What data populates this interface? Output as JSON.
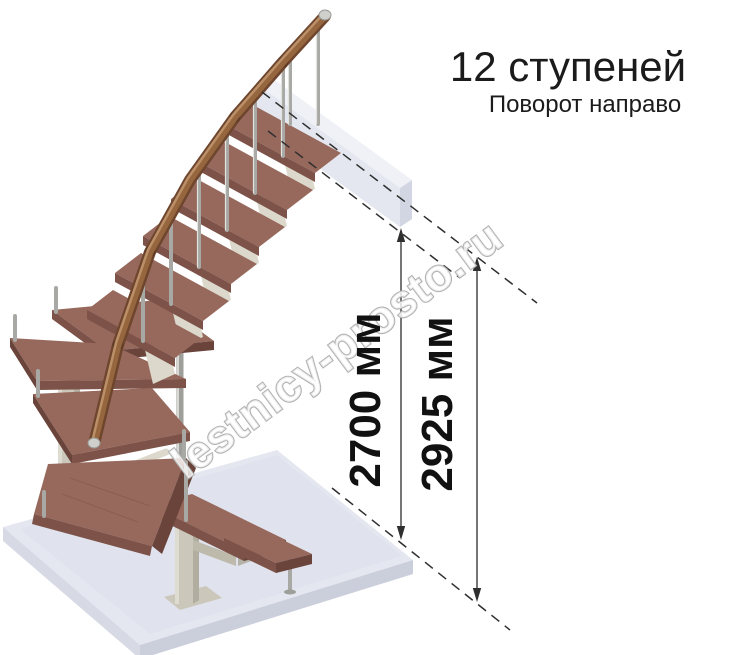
{
  "header": {
    "title": "12 ступеней",
    "subtitle": "Поворот направо"
  },
  "dimensions": {
    "inner_height": "2700 мм",
    "outer_height": "2925 мм"
  },
  "watermark": {
    "text": "lestnicy-prosto.ru"
  },
  "illustration": {
    "kind": "modular staircase, right turn, 12 steps"
  },
  "colors": {
    "wood_top": "#97695d",
    "wood_front": "#7d5248",
    "wood_side": "#6a443b",
    "rail_dark": "#6e452d",
    "rail_mid": "#96663f",
    "rail_light": "#bb9068",
    "metal": "#a8a8a4",
    "support": "#cbc7ba",
    "floor_top": "#e5e7f0",
    "floor_left": "#d7dae4",
    "floor_right": "#cbcfdb",
    "beam_top": "#eef0f6",
    "beam_front": "#e2e5ee",
    "beam_side": "#ced3e0",
    "dim_line": "#3c3c3c",
    "wm_outline": "#b3b3b3"
  }
}
